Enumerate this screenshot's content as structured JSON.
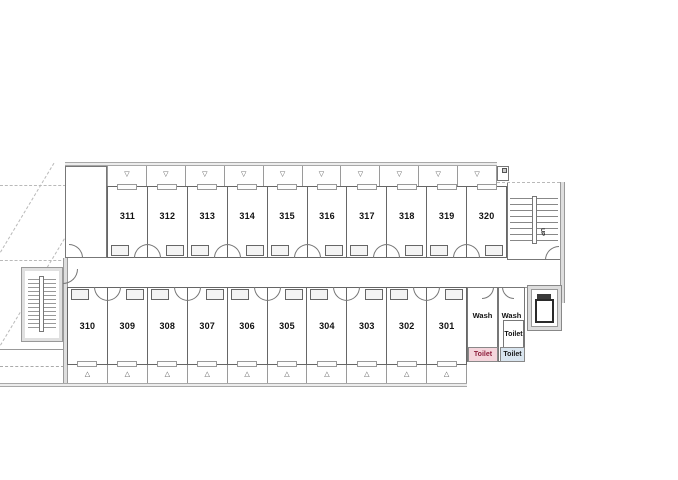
{
  "plan": {
    "rooms_top": [
      {
        "number": "311"
      },
      {
        "number": "312"
      },
      {
        "number": "313"
      },
      {
        "number": "314"
      },
      {
        "number": "315"
      },
      {
        "number": "316"
      },
      {
        "number": "317"
      },
      {
        "number": "318"
      },
      {
        "number": "319"
      },
      {
        "number": "320"
      }
    ],
    "rooms_bottom": [
      {
        "number": "310"
      },
      {
        "number": "309"
      },
      {
        "number": "308"
      },
      {
        "number": "307"
      },
      {
        "number": "306"
      },
      {
        "number": "305"
      },
      {
        "number": "304"
      },
      {
        "number": "303"
      },
      {
        "number": "302"
      },
      {
        "number": "301"
      }
    ],
    "facilities": {
      "wash_left": "Wash",
      "wash_right": "Wash",
      "toilet_small": "Toilet",
      "toilet_pink": "Toilet",
      "toilet_blue": "Toilet"
    },
    "stairs": {
      "up_label": "UP"
    },
    "symbols": {
      "balcony_top": "▽",
      "balcony_bottom": "△"
    },
    "colors": {
      "toilet_pink_bg": "#f4d5dc",
      "toilet_pink_text": "#8e1f3d",
      "toilet_blue_bg": "#d9e5ef",
      "toilet_blue_text": "#1a1a1a"
    }
  }
}
